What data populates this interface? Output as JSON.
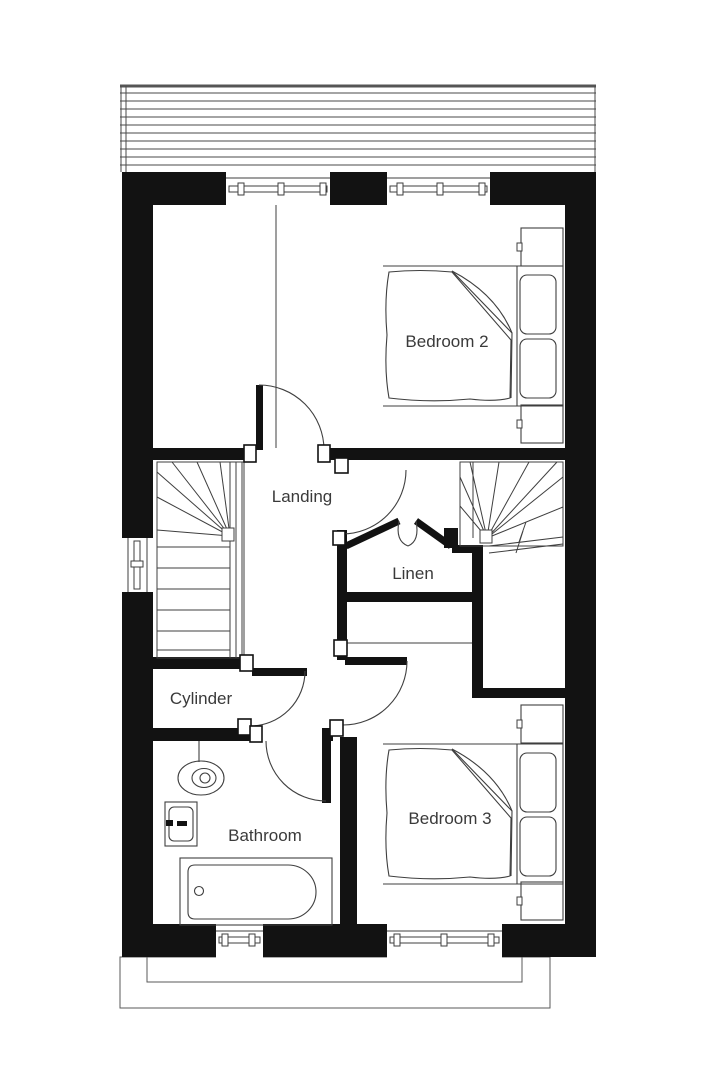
{
  "plan": {
    "type": "floor-plan",
    "style": "black-wall architectural plan, white background",
    "colors": {
      "wall": "#121212",
      "furniture_line": "#3f3f3f",
      "roof_hatch_line": "#4a4a4a",
      "label_text": "#3a3a3a",
      "background": "#ffffff"
    }
  },
  "rooms": [
    {
      "name": "bedroom-2",
      "label": "Bedroom 2"
    },
    {
      "name": "landing",
      "label": "Landing"
    },
    {
      "name": "linen",
      "label": "Linen"
    },
    {
      "name": "cylinder",
      "label": "Cylinder"
    },
    {
      "name": "bathroom",
      "label": "Bathroom"
    },
    {
      "name": "bedroom-3",
      "label": "Bedroom 3"
    }
  ],
  "fixtures": [
    {
      "icon": "double-bed-icon",
      "room": "Bedroom 2"
    },
    {
      "icon": "bedside-table-icon",
      "room": "Bedroom 2",
      "count": 2
    },
    {
      "icon": "double-bed-icon",
      "room": "Bedroom 3"
    },
    {
      "icon": "bedside-table-icon",
      "room": "Bedroom 3",
      "count": 2
    },
    {
      "icon": "staircase-icon",
      "room": "Landing",
      "count": 2
    },
    {
      "icon": "toilet-icon",
      "room": "Bathroom"
    },
    {
      "icon": "basin-icon",
      "room": "Bathroom"
    },
    {
      "icon": "bathtub-icon",
      "room": "Bathroom"
    },
    {
      "icon": "window-icon",
      "count": 5
    },
    {
      "icon": "door-swing-icon",
      "count": 5
    },
    {
      "icon": "double-door-icon",
      "room": "Linen"
    },
    {
      "icon": "roof-hatch-icon",
      "position": "top"
    },
    {
      "icon": "terrace-outline-icon",
      "position": "bottom"
    }
  ]
}
